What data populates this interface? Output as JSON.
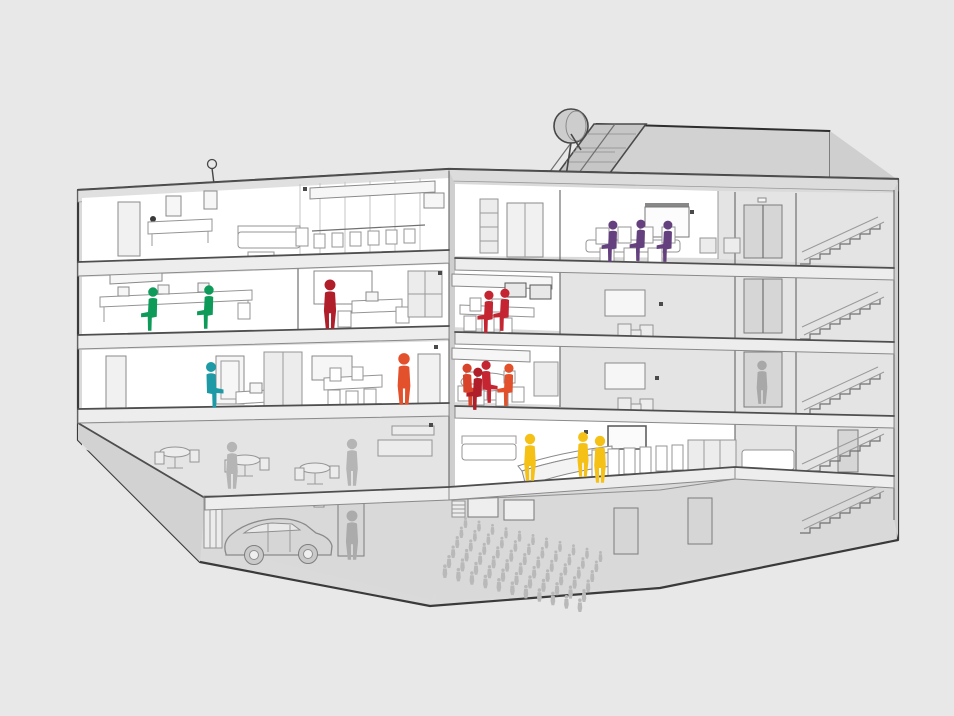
{
  "scene": {
    "description": "Cutaway cross-section illustration of a five-storey office building with highlighted teams of people on different floors",
    "background_color": "#e8e8e8"
  },
  "palette": {
    "background": "#e8e8e8",
    "wall": "#dadada",
    "fascia": "#e0e0e0",
    "penthouse": "#d2d2d2",
    "solar_panel": "#c6c6c6",
    "dish": "#cdcdcd",
    "room_white": "#ffffff",
    "room_gray": "#e4e4e4",
    "silhouette_gray": "#b3b3b3"
  },
  "roof": {
    "elements": [
      "satellite-dish",
      "solar-panel-array",
      "penthouse",
      "antenna"
    ]
  },
  "figures": {
    "groups": [
      {
        "id": "purple-meeting-team",
        "color": "#64407e",
        "pose": "sit",
        "scale": 0.9,
        "flip": true,
        "positions": [
          {
            "x": 612,
            "y": 262
          },
          {
            "x": 640,
            "y": 261
          },
          {
            "x": 667,
            "y": 262
          }
        ]
      },
      {
        "id": "green-desk-team",
        "color": "#0e9b5a",
        "pose": "sit",
        "scale": 0.95,
        "flip": true,
        "positions": [
          {
            "x": 152,
            "y": 331
          },
          {
            "x": 208,
            "y": 329
          }
        ]
      },
      {
        "id": "red-presenter",
        "color": "#b01e2a",
        "pose": "stand",
        "scale": 1.05,
        "positions": [
          {
            "x": 330,
            "y": 329
          }
        ]
      },
      {
        "id": "red-meeting-pair",
        "color": "#c42531",
        "pose": "sit",
        "scale": 0.92,
        "flip": true,
        "positions": [
          {
            "x": 488,
            "y": 333
          },
          {
            "x": 504,
            "y": 331
          }
        ]
      },
      {
        "id": "teal-office-worker",
        "color": "#1d9aa5",
        "pose": "sit",
        "scale": 1.0,
        "positions": [
          {
            "x": 212,
            "y": 408
          }
        ]
      },
      {
        "id": "orange-standing-worker",
        "color": "#e2512b",
        "pose": "stand",
        "scale": 1.1,
        "positions": [
          {
            "x": 404,
            "y": 405
          }
        ]
      },
      {
        "id": "round-table-team",
        "color": "#d8432b",
        "pose": "sit",
        "scale": 0.92,
        "positions": [
          {
            "x": 468,
            "y": 406
          },
          {
            "x": 487,
            "y": 403,
            "color": "#c42531"
          },
          {
            "x": 508,
            "y": 406,
            "flip": true,
            "color": "#e2512b"
          },
          {
            "x": 477,
            "y": 410,
            "flip": true,
            "color": "#b01e2a"
          }
        ]
      },
      {
        "id": "yellow-reception-team",
        "color": "#f5c117",
        "pose": "stand",
        "scale": 1.0,
        "positions": [
          {
            "x": 530,
            "y": 481
          },
          {
            "x": 583,
            "y": 477,
            "scale": 0.95
          },
          {
            "x": 600,
            "y": 483
          }
        ]
      },
      {
        "id": "cafeteria-silhouettes",
        "color": "#b5b5b5",
        "pose": "stand",
        "scale": 1.0,
        "positions": [
          {
            "x": 232,
            "y": 489
          },
          {
            "x": 352,
            "y": 486
          }
        ]
      },
      {
        "id": "garage-silhouette",
        "color": "#ababab",
        "pose": "stand",
        "scale": 1.05,
        "positions": [
          {
            "x": 352,
            "y": 560
          }
        ]
      },
      {
        "id": "elevator-silhouette",
        "color": "#a8a8a8",
        "pose": "stand",
        "scale": 0.92,
        "positions": [
          {
            "x": 762,
            "y": 404
          }
        ]
      }
    ]
  },
  "crowd": {
    "id": "auditorium-audience",
    "color": "#b9b9b9",
    "rows": 6,
    "cols": 11,
    "origin": {
      "x": 468,
      "y": 528
    },
    "col_dx": 13.5,
    "col_dy": 3.4,
    "row_dx": -4,
    "row_dy": 10,
    "base_scale": 0.5,
    "scale_step": 0.024
  }
}
